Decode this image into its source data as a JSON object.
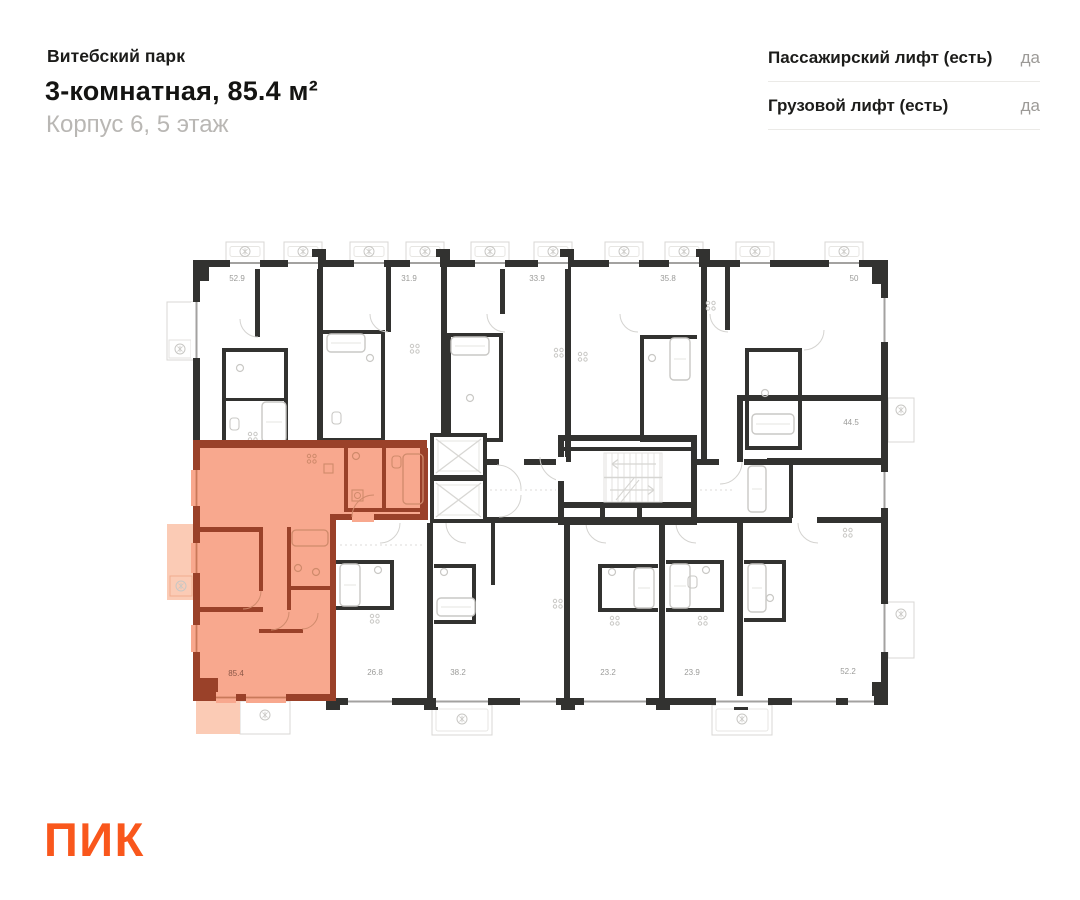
{
  "header": {
    "project": "Витебский парк",
    "title": "3-комнатная, 85.4 м²",
    "subtitle": "Корпус 6, 5 этаж"
  },
  "features": [
    {
      "label": "Пассажирский лифт (есть)",
      "value": "да"
    },
    {
      "label": "Грузовой лифт (есть)",
      "value": "да"
    }
  ],
  "plan": {
    "highlighted_unit": {
      "area": "85.4",
      "x": 236,
      "y": 676
    },
    "units": [
      {
        "area": "52.9",
        "x": 237,
        "y": 281
      },
      {
        "area": "31.9",
        "x": 409,
        "y": 281
      },
      {
        "area": "33.9",
        "x": 537,
        "y": 281
      },
      {
        "area": "35.8",
        "x": 668,
        "y": 281
      },
      {
        "area": "50",
        "x": 854,
        "y": 281
      },
      {
        "area": "44.5",
        "x": 851,
        "y": 425
      },
      {
        "area": "26.8",
        "x": 375,
        "y": 675
      },
      {
        "area": "38.2",
        "x": 458,
        "y": 675
      },
      {
        "area": "23.2",
        "x": 608,
        "y": 675
      },
      {
        "area": "23.9",
        "x": 692,
        "y": 675
      },
      {
        "area": "52.2",
        "x": 848,
        "y": 674
      }
    ]
  },
  "logo": {
    "text": "ПИК"
  },
  "colors": {
    "accent": "#F9571C",
    "highlight_fill": "#F8A88E",
    "highlight_wall": "#9A4129",
    "highlight_balcony": "#FBCBB5",
    "wall": "#323230",
    "fixture": "#c9c8c5",
    "label": "#9b9b99"
  }
}
